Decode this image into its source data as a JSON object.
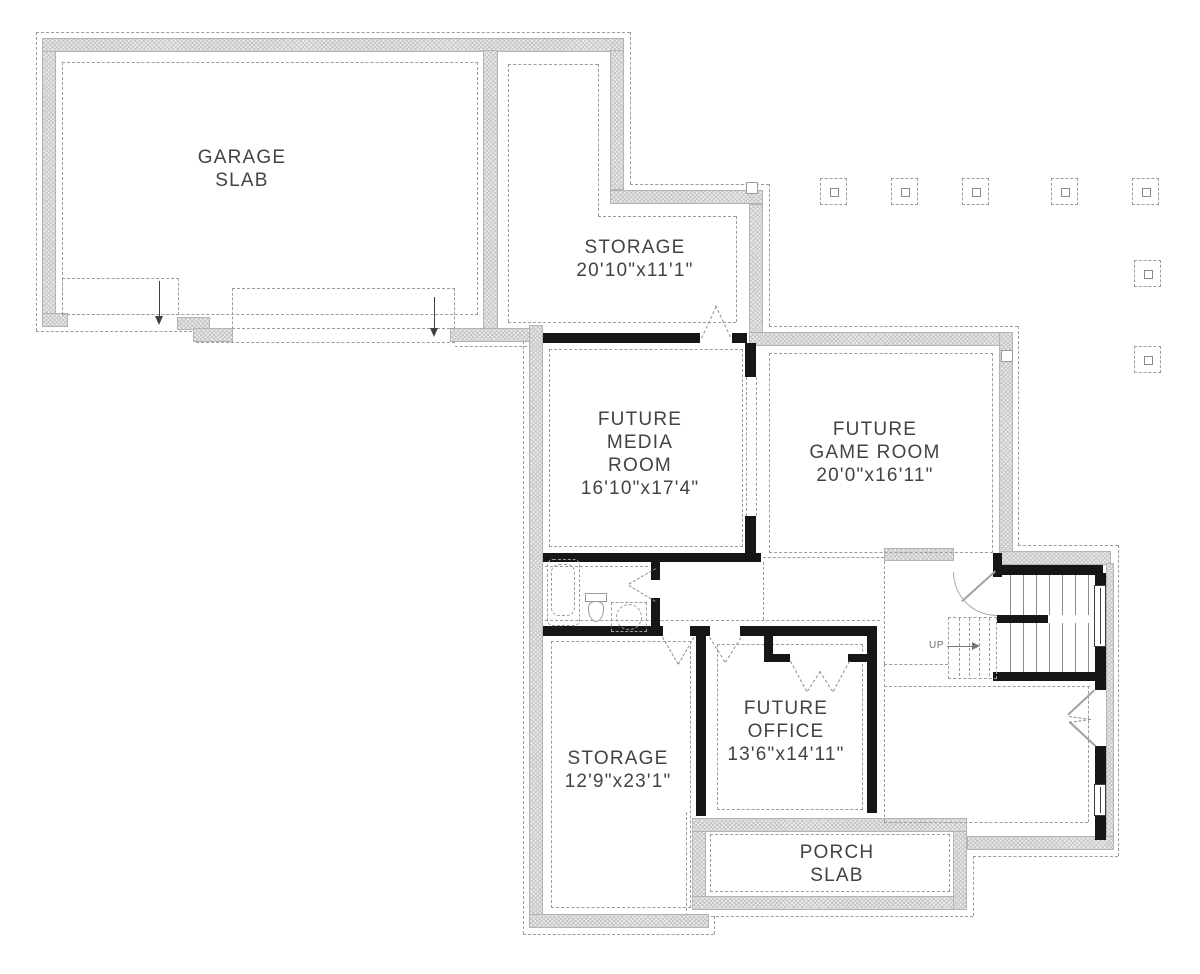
{
  "labels": {
    "garage": {
      "line1": "GARAGE",
      "line2": "SLAB"
    },
    "storage_upper": {
      "name": "STORAGE",
      "dims": "20'10\"x11'1\""
    },
    "media": {
      "line1": "FUTURE",
      "line2": "MEDIA",
      "line3": "ROOM",
      "dims": "16'10\"x17'4\""
    },
    "game": {
      "line1": "FUTURE",
      "line2": "GAME ROOM",
      "dims": "20'0\"x16'11\""
    },
    "office": {
      "line1": "FUTURE",
      "line2": "OFFICE",
      "dims": "13'6\"x14'11\""
    },
    "storage_lower": {
      "name": "STORAGE",
      "dims": "12'9\"x23'1\""
    },
    "porch": {
      "line1": "PORCH",
      "line2": "SLAB"
    },
    "stairs": {
      "up": "UP"
    }
  },
  "colors": {
    "wall_hatch_fill": "#ebebeb",
    "wall_edge": "#b4b4b4",
    "framed_wall": "#161616",
    "dashed_line": "#9c9c9c",
    "text": "#434343",
    "background": "#ffffff"
  },
  "counts": {
    "column_footings": 7,
    "windows": 2,
    "garage_door_openings": 2
  }
}
